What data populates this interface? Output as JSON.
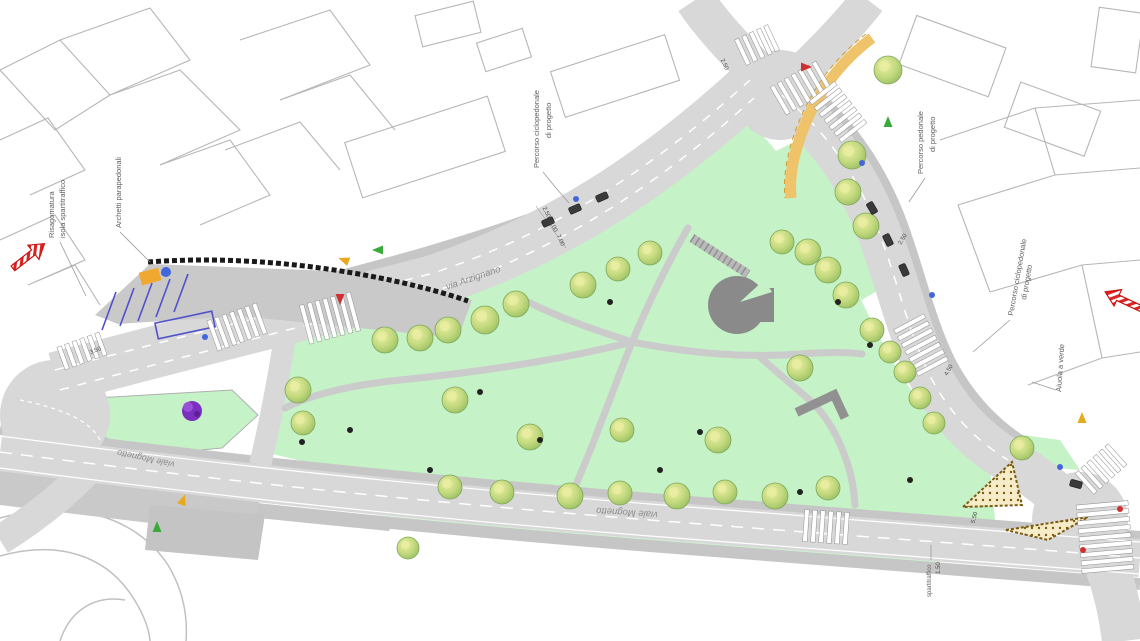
{
  "plan": {
    "colors": {
      "park_green": "#c5f2c6",
      "verge_green": "#cdf3cf",
      "road_gray": "#d8d8d8",
      "sidewalk_gray": "#c6c6c6",
      "parking_gray": "#c9c9c9",
      "path_gray": "#cbcbcb",
      "building_dark_gray": "#8a8a8a",
      "tree_green": "#a8cd70",
      "tree_highlight": "#e9eda2",
      "bike_lane_orange": "#eec36a",
      "parking_line_blue": "#5050cc",
      "wall_black": "#1a1a1a",
      "direction_arrow_red": "#dd2222",
      "island_hatch_brown": "#8a6d1a",
      "bush_purple": "#7b2fbe"
    },
    "labels": [
      {
        "text": "Risagomatura",
        "x": 54,
        "y": 238,
        "rot": -90,
        "size": 7.5,
        "cls": "annotation"
      },
      {
        "text": "isola spartitraffico",
        "x": 65,
        "y": 238,
        "rot": -90,
        "size": 7.5,
        "cls": "annotation"
      },
      {
        "text": "Archetti parapedonali",
        "x": 121,
        "y": 228,
        "rot": -90,
        "size": 7.5,
        "cls": "annotation"
      },
      {
        "text": "Percorso ciclopedonale",
        "x": 539,
        "y": 168,
        "rot": -90,
        "size": 7.5,
        "cls": "annotation"
      },
      {
        "text": "di progetto",
        "x": 551,
        "y": 138,
        "rot": -90,
        "size": 7.5,
        "cls": "annotation"
      },
      {
        "text": "Percorso pedonale",
        "x": 923,
        "y": 174,
        "rot": -90,
        "size": 7.5,
        "cls": "annotation"
      },
      {
        "text": "di progetto",
        "x": 935,
        "y": 152,
        "rot": -90,
        "size": 7.5,
        "cls": "annotation"
      },
      {
        "text": "Percorso ciclopedonale",
        "x": 1013,
        "y": 316,
        "rot": -80,
        "size": 7.5,
        "cls": "annotation"
      },
      {
        "text": "di progetto",
        "x": 1026,
        "y": 300,
        "rot": -80,
        "size": 7.5,
        "cls": "annotation"
      },
      {
        "text": "Aiuola a verde",
        "x": 1061,
        "y": 392,
        "rot": -86,
        "size": 7.5,
        "cls": "annotation"
      },
      {
        "text": "spartitraffico",
        "x": 931,
        "y": 597,
        "rot": -90,
        "size": 6,
        "cls": "annotation"
      },
      {
        "text": "via Arzignano",
        "x": 447,
        "y": 290,
        "rot": -19,
        "size": 9.5,
        "cls": "street"
      },
      {
        "text": "viale Mognetto",
        "x": 175,
        "y": 462,
        "rot": 192,
        "size": 9,
        "cls": "street"
      },
      {
        "text": "viale Mognetto",
        "x": 658,
        "y": 512,
        "rot": 184,
        "size": 9.5,
        "cls": "street"
      }
    ],
    "dimensions": [
      {
        "text": "2.50",
        "x": 545,
        "y": 213,
        "rot": 65
      },
      {
        "text": "3.00",
        "x": 552,
        "y": 227,
        "rot": 65
      },
      {
        "text": "7.00",
        "x": 559,
        "y": 241,
        "rot": 65
      },
      {
        "text": "2.50",
        "x": 723,
        "y": 65,
        "rot": 65
      },
      {
        "text": "2.50",
        "x": 904,
        "y": 240,
        "rot": -60
      },
      {
        "text": "4.50",
        "x": 950,
        "y": 371,
        "rot": -60
      },
      {
        "text": "5.50",
        "x": 976,
        "y": 518,
        "rot": -75
      },
      {
        "text": "1.50",
        "x": 940,
        "y": 568,
        "rot": -90
      },
      {
        "text": "3.50",
        "x": 96,
        "y": 352,
        "rot": -22
      }
    ],
    "trees": [
      [
        298,
        390,
        13
      ],
      [
        303,
        423,
        12
      ],
      [
        385,
        340,
        13
      ],
      [
        420,
        338,
        13
      ],
      [
        448,
        330,
        13
      ],
      [
        485,
        320,
        14
      ],
      [
        516,
        304,
        13
      ],
      [
        583,
        285,
        13
      ],
      [
        618,
        269,
        12
      ],
      [
        650,
        253,
        12
      ],
      [
        782,
        242,
        12
      ],
      [
        808,
        252,
        13
      ],
      [
        828,
        270,
        13
      ],
      [
        846,
        295,
        13
      ],
      [
        872,
        330,
        12
      ],
      [
        890,
        352,
        11
      ],
      [
        852,
        155,
        14
      ],
      [
        848,
        192,
        13
      ],
      [
        866,
        226,
        13
      ],
      [
        888,
        70,
        14
      ],
      [
        905,
        372,
        11
      ],
      [
        920,
        398,
        11
      ],
      [
        934,
        423,
        11
      ],
      [
        1022,
        448,
        12
      ],
      [
        455,
        400,
        13
      ],
      [
        530,
        437,
        13
      ],
      [
        622,
        430,
        12
      ],
      [
        718,
        440,
        13
      ],
      [
        800,
        368,
        13
      ],
      [
        450,
        487,
        12
      ],
      [
        502,
        492,
        12
      ],
      [
        570,
        496,
        13
      ],
      [
        620,
        493,
        12
      ],
      [
        677,
        496,
        13
      ],
      [
        725,
        492,
        12
      ],
      [
        775,
        496,
        13
      ],
      [
        828,
        488,
        12
      ],
      [
        408,
        548,
        11
      ]
    ],
    "crossings": [
      {
        "x": 82,
        "y": 351,
        "rot": -20,
        "n": 6,
        "len": 24
      },
      {
        "x": 237,
        "y": 327,
        "rot": -20,
        "n": 7,
        "len": 32
      },
      {
        "x": 330,
        "y": 318,
        "rot": -15,
        "n": 7,
        "len": 40
      },
      {
        "x": 757,
        "y": 45,
        "rot": -25,
        "n": 5,
        "len": 28
      },
      {
        "x": 801,
        "y": 88,
        "rot": -30,
        "n": 7,
        "len": 32
      },
      {
        "x": 838,
        "y": 112,
        "rot": 52,
        "n": 7,
        "len": 32
      },
      {
        "x": 921,
        "y": 345,
        "rot": 62,
        "n": 7,
        "len": 34
      },
      {
        "x": 826,
        "y": 527,
        "rot": 4,
        "n": 6,
        "len": 32
      },
      {
        "x": 1105,
        "y": 537,
        "rot": 85,
        "n": 9,
        "len": 52
      },
      {
        "x": 1101,
        "y": 469,
        "rot": -42,
        "n": 6,
        "len": 28
      }
    ],
    "markers": {
      "arrows": [
        {
          "c": "#3aaa3a",
          "x": 888,
          "y": 122,
          "rot": 0
        },
        {
          "c": "#3aaa3a",
          "x": 378,
          "y": 250,
          "rot": -90
        },
        {
          "c": "#3aaa3a",
          "x": 157,
          "y": 527,
          "rot": 0
        },
        {
          "c": "#e8a820",
          "x": 1082,
          "y": 418,
          "rot": 0
        },
        {
          "c": "#e8a820",
          "x": 344,
          "y": 260,
          "rot": -70
        },
        {
          "c": "#e8a820",
          "x": 183,
          "y": 500,
          "rot": 20
        },
        {
          "c": "#d03030",
          "x": 340,
          "y": 299,
          "rot": 180
        },
        {
          "c": "#d03030",
          "x": 806,
          "y": 67,
          "rot": 90
        }
      ],
      "dots": [
        {
          "c": "#4466dd",
          "x": 576,
          "y": 199
        },
        {
          "c": "#4466dd",
          "x": 164,
          "y": 273
        },
        {
          "c": "#4466dd",
          "x": 862,
          "y": 163
        },
        {
          "c": "#4466dd",
          "x": 932,
          "y": 295
        },
        {
          "c": "#4466dd",
          "x": 1060,
          "y": 467
        },
        {
          "c": "#4466dd",
          "x": 205,
          "y": 337
        },
        {
          "c": "#d03030",
          "x": 1120,
          "y": 509
        },
        {
          "c": "#d03030",
          "x": 1083,
          "y": 550
        },
        {
          "c": "#222222",
          "x": 480,
          "y": 392
        },
        {
          "c": "#222222",
          "x": 610,
          "y": 302
        },
        {
          "c": "#222222",
          "x": 700,
          "y": 432
        },
        {
          "c": "#222222",
          "x": 800,
          "y": 492
        },
        {
          "c": "#222222",
          "x": 302,
          "y": 442
        },
        {
          "c": "#222222",
          "x": 838,
          "y": 302
        },
        {
          "c": "#222222",
          "x": 540,
          "y": 440
        },
        {
          "c": "#222222",
          "x": 660,
          "y": 470
        },
        {
          "c": "#222222",
          "x": 870,
          "y": 345
        },
        {
          "c": "#222222",
          "x": 910,
          "y": 480
        },
        {
          "c": "#222222",
          "x": 430,
          "y": 470
        },
        {
          "c": "#222222",
          "x": 350,
          "y": 430
        }
      ],
      "cars": [
        {
          "x": 548,
          "y": 222,
          "rot": -24
        },
        {
          "x": 575,
          "y": 209,
          "rot": -24
        },
        {
          "x": 602,
          "y": 197,
          "rot": -24
        },
        {
          "x": 872,
          "y": 208,
          "rot": 60
        },
        {
          "x": 888,
          "y": 240,
          "rot": 64
        },
        {
          "x": 904,
          "y": 270,
          "rot": 66
        },
        {
          "x": 1076,
          "y": 484,
          "rot": 15
        }
      ]
    }
  }
}
